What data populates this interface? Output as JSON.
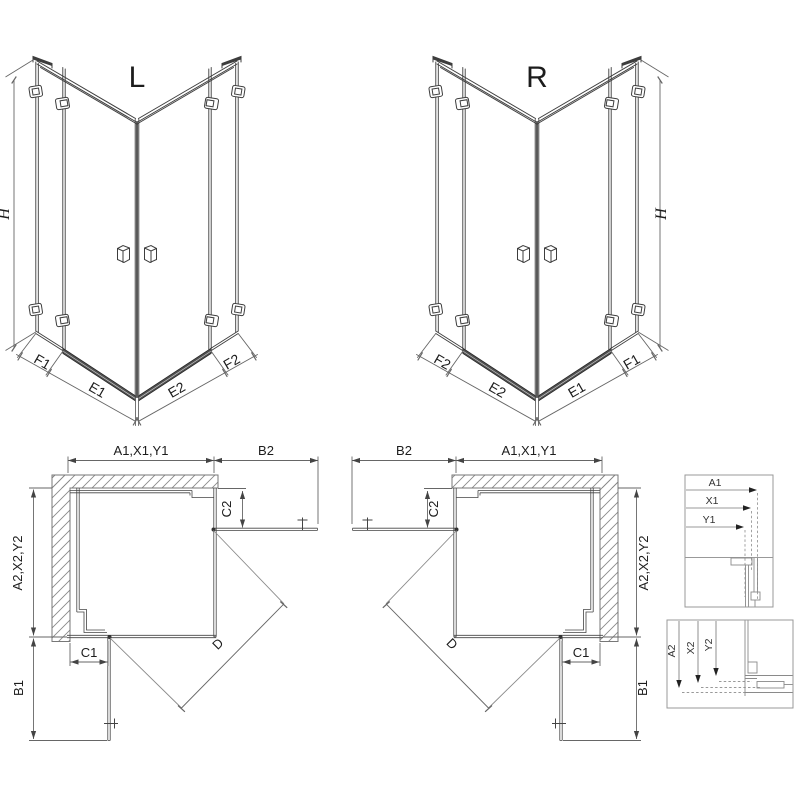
{
  "views3d": {
    "left": {
      "label": "L",
      "height_label": "H",
      "bottom_labels": [
        "F1",
        "E1",
        "E2",
        "F2"
      ]
    },
    "right": {
      "label": "R",
      "height_label": "H",
      "bottom_labels": [
        "F2",
        "E2",
        "E1",
        "F1"
      ]
    }
  },
  "plans": {
    "left": {
      "top_dim": "A1,X1,Y1",
      "top_door_dim": "B2",
      "top_fixed_dim": "C2",
      "side_dim": "A2,X2,Y2",
      "side_fixed_dim": "C1",
      "side_door_dim": "B1",
      "diagonal_dim": "D"
    },
    "right": {
      "top_dim": "A1,X1,Y1",
      "top_door_dim": "B2",
      "top_fixed_dim": "C2",
      "side_dim": "A2,X2,Y2",
      "side_fixed_dim": "C1",
      "side_door_dim": "B1",
      "diagonal_dim": "D"
    }
  },
  "detail_panels": {
    "top": {
      "labels": [
        "A1",
        "X1",
        "Y1"
      ]
    },
    "bottom": {
      "labels": [
        "A2",
        "X2",
        "Y2"
      ]
    }
  },
  "colors": {
    "line": "#3d3d3d",
    "wall_outline": "#777777",
    "dimension": "#666666",
    "threshold": "#4f4f4f",
    "background": "#ffffff"
  }
}
